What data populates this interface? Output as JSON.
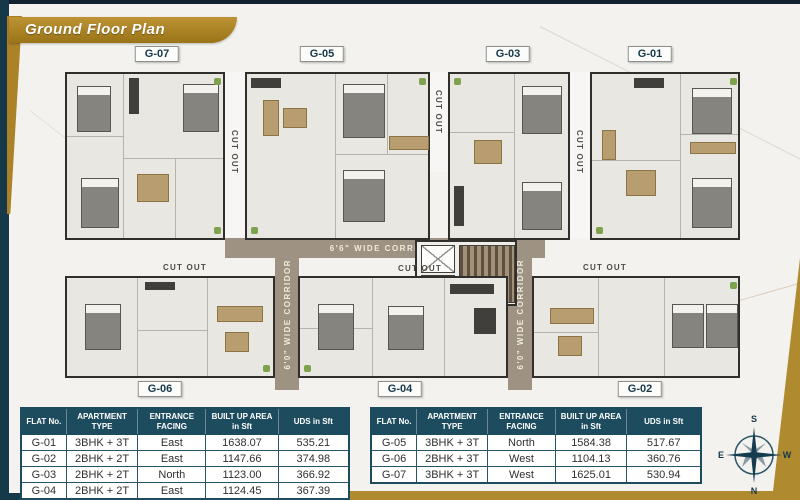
{
  "header": {
    "title": "Ground Floor Plan"
  },
  "plan": {
    "units_top": [
      "G-07",
      "G-05",
      "G-03",
      "G-01"
    ],
    "units_bottom": [
      "G-06",
      "G-04",
      "G-02"
    ],
    "cut_out": "CUT OUT",
    "corridor_horizontal": "6'6\" WIDE CORRIDOR",
    "corridor_vertical": "6'0\" WIDE CORRIDOR"
  },
  "compass": {
    "top": "S",
    "bottom": "N",
    "left": "E",
    "right": "W"
  },
  "tables": [
    {
      "headers": [
        "FLAT No.",
        "APARTMENT TYPE",
        "ENTRANCE FACING",
        "BUILT UP AREA in Sft",
        "UDS in Sft"
      ],
      "rows": [
        [
          "G-01",
          "3BHK + 3T",
          "East",
          "1638.07",
          "535.21"
        ],
        [
          "G-02",
          "2BHK + 2T",
          "East",
          "1147.66",
          "374.98"
        ],
        [
          "G-03",
          "2BHK + 2T",
          "North",
          "1123.00",
          "366.92"
        ],
        [
          "G-04",
          "2BHK + 2T",
          "East",
          "1124.45",
          "367.39"
        ]
      ]
    },
    {
      "headers": [
        "FLAT No.",
        "APARTMENT TYPE",
        "ENTRANCE FACING",
        "BUILT UP AREA in Sft",
        "UDS in Sft"
      ],
      "rows": [
        [
          "G-05",
          "3BHK + 3T",
          "North",
          "1584.38",
          "517.67"
        ],
        [
          "G-06",
          "2BHK + 3T",
          "West",
          "1104.13",
          "360.76"
        ],
        [
          "G-07",
          "3BHK + 3T",
          "West",
          "1625.01",
          "530.94"
        ]
      ]
    }
  ],
  "colors": {
    "accent_gold": "#ac8228",
    "accent_teal": "#1d4c5f"
  }
}
